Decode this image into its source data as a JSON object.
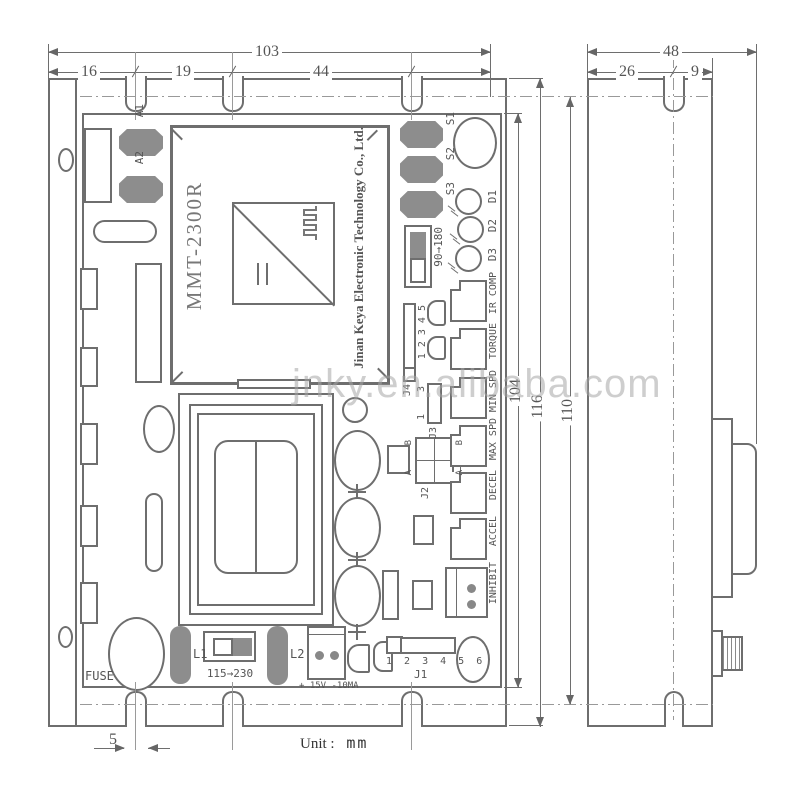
{
  "drawing": {
    "watermark": "jnky.en.alibaba.com",
    "unit_label": "Unit :",
    "unit_value": "mm"
  },
  "dimensions": {
    "front_total_width": "103",
    "front_seg_left": "16",
    "front_seg_mid": "19",
    "front_seg_right": "44",
    "side_total_width": "48",
    "side_seg_left": "26",
    "side_seg_right": "9",
    "pcb_height": "104",
    "plate_height": "116",
    "mount_height": "110",
    "slot_width": "5"
  },
  "ic": {
    "model": "MMT-2300R",
    "company": "Jinan Keya Electronic Technology Co., Ltd."
  },
  "components": {
    "a1": "A1",
    "a2": "A2",
    "s1": "S1",
    "s2": "S2",
    "s3": "S3",
    "d1": "D1",
    "d2": "D2",
    "d3": "D3",
    "range_switch": "90→180",
    "j4_label": "J4",
    "j4_pins": "1 2 3 4 5",
    "j3_label": "J3",
    "j3_pin_top": "3",
    "j3_pin_bottom": "1",
    "j2_label": "J2",
    "j2_b": "B",
    "j2_a": "A",
    "pot_labels": [
      "IR COMP",
      "TORQUE",
      "MIN SPD",
      "MAX SPD",
      "DECEL",
      "ACCEL"
    ],
    "inhibit": "INHIBIT",
    "fuse": "FUSE",
    "l1": "L1",
    "l2": "L2",
    "voltage_switch": "115→230",
    "power_rating": "+ 15V -10MA",
    "j1_label": "J1",
    "j1_pins": "1 2 3 4 5 6"
  }
}
